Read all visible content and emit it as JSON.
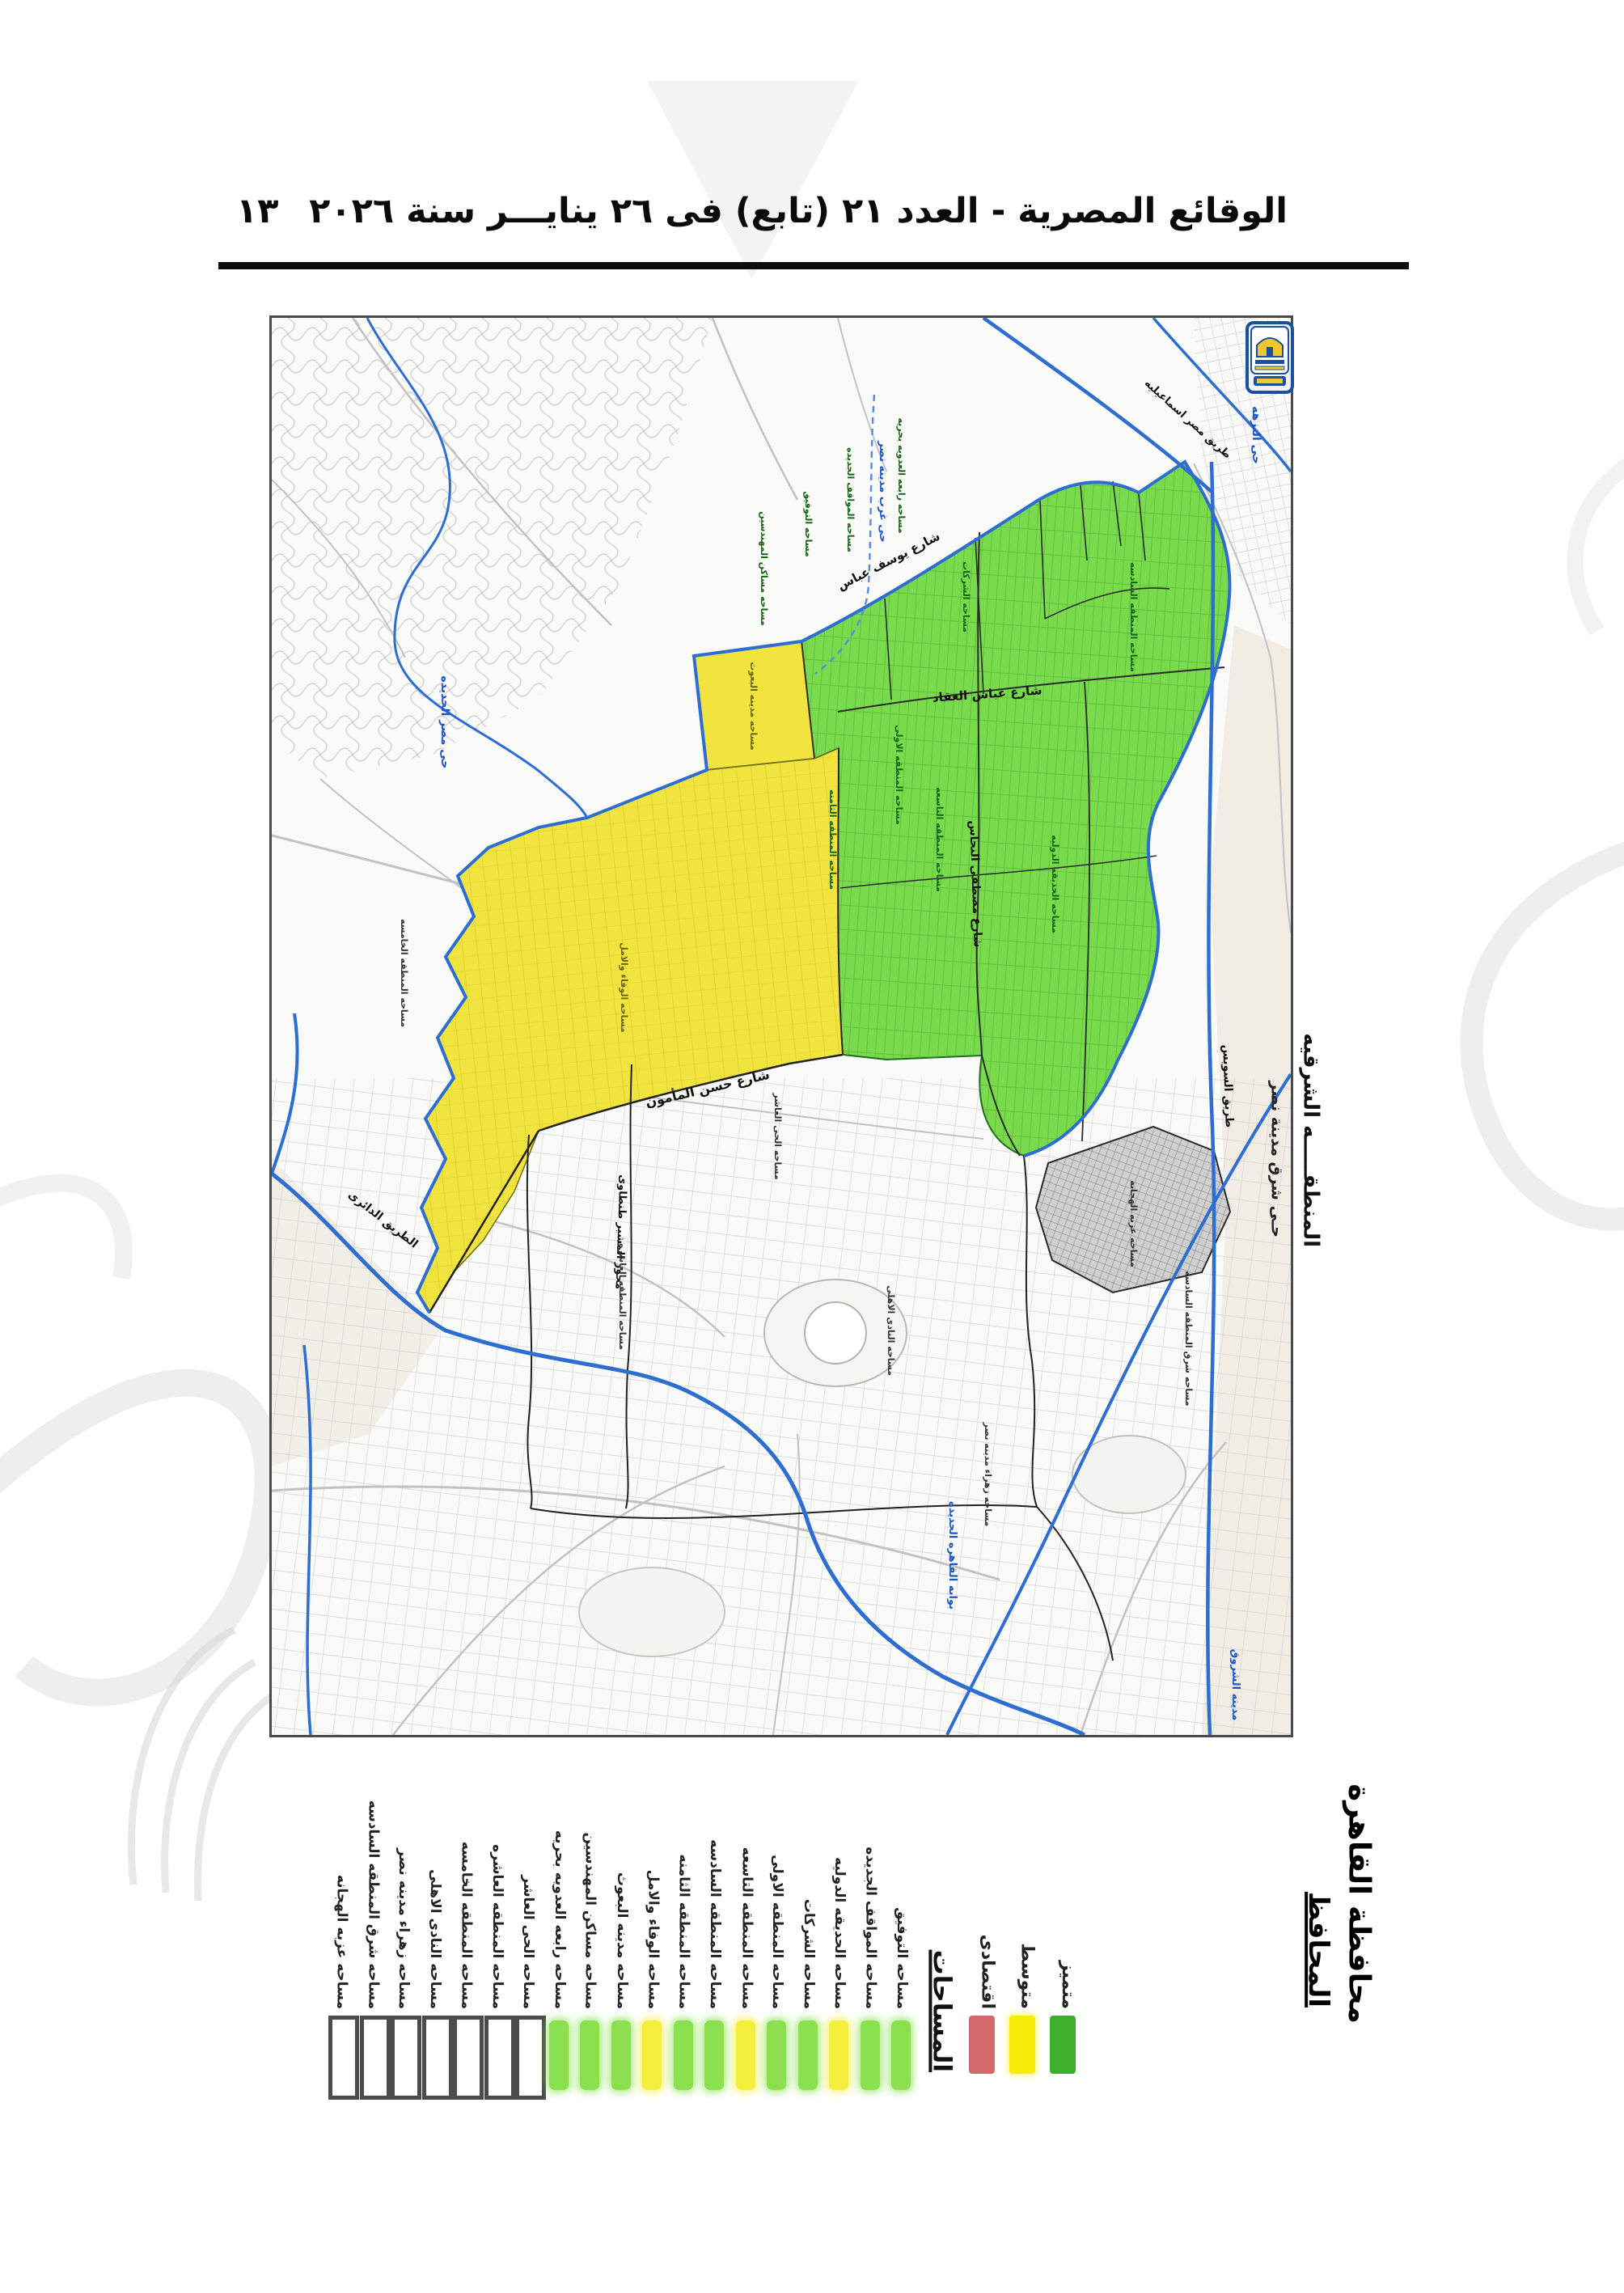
{
  "header": {
    "title": "الوقائع المصرية - العدد ٢١ (تابع) فى ٢٦ ينايـــر سنة ٢٠٢٦",
    "page_number": "١٣"
  },
  "map": {
    "region_title": "المنطقـــــه الشرقيه",
    "region_subtitle": "حـى شرق مدينة نصر",
    "streets": [
      "شارع يوسف عباس",
      "شارع عباس العقاد",
      "شارع مصطفى النحاس",
      "شارع حسن المأمون",
      "طريق السويس",
      "الطريق الدائرى",
      "محور المشير طنطاوى",
      "طريق مصر اسماعيليه"
    ],
    "district_labels": [
      "حى مصر الجديده",
      "حى النزهه",
      "حى غرب مدينه نصر",
      "بوابه القاهره الجديده",
      "مدينه الشروق"
    ],
    "green_area_labels": [
      "مساحه مساكن المهندسين",
      "مساحه التوفيق",
      "مساحه المواقف الجديده",
      "مساحه رابعه العدويه بحريه",
      "مساحه الشركات",
      "مساحه المنطقه السادسه",
      "مساحه المنطقه الاولى",
      "مساحه المنطقه الثامنه",
      "مساحه المنطقه التاسعه",
      "مساحه الحديقه الدوليه"
    ],
    "yellow_area_labels": [
      "مساحه الوفاء والامل",
      "مساحه مدينه البعوث"
    ],
    "gray_area_labels": [
      "مساحه الحى العاشر",
      "مساحه المنطقه العاشره",
      "مساحه المنطقه الخامسه",
      "مساحه عزبه الهجانه",
      "مساحه زهراء مدينه نصر",
      "مساحه النادى الاهلى",
      "مساحه شرق المنطقه السادسه"
    ]
  },
  "legend": {
    "heading": "المساحات",
    "categories": [
      {
        "label": "اقتصادى",
        "color": "#d4696c"
      },
      {
        "label": "متوسط",
        "color": "#f6ee08"
      },
      {
        "label": "متميز",
        "color": "#3fae2a"
      }
    ],
    "areas": [
      {
        "label": "مساحه عزبه الهجانه",
        "swatch": "outline"
      },
      {
        "label": "مساحه شرق المنطقه السادسه",
        "swatch": "outline"
      },
      {
        "label": "مساحه زهراء مدينه نصر",
        "swatch": "outline"
      },
      {
        "label": "مساحه النادى الاهلى",
        "swatch": "outline"
      },
      {
        "label": "مساحه المنطقه الخامسه",
        "swatch": "outline"
      },
      {
        "label": "مساحه المنطقه العاشره",
        "swatch": "outline"
      },
      {
        "label": "مساحه الحى العاشر",
        "swatch": "outline"
      },
      {
        "label": "مساحه رابعه العدويه بحريه",
        "swatch": "green"
      },
      {
        "label": "مساحه مساكن المهندسين",
        "swatch": "green"
      },
      {
        "label": "مساحه مدينه البعوث",
        "swatch": "green"
      },
      {
        "label": "مساحه الوفاء والامل",
        "swatch": "yellow"
      },
      {
        "label": "مساحه المنطقه الثامنه",
        "swatch": "green"
      },
      {
        "label": "مساحه المنطقه السادسه",
        "swatch": "green"
      },
      {
        "label": "مساحه المنطقه التاسعه",
        "swatch": "yellow"
      },
      {
        "label": "مساحه المنطقه الاولى",
        "swatch": "green"
      },
      {
        "label": "مساحه الشركات",
        "swatch": "green"
      },
      {
        "label": "مساحه الحديقه الدوليه",
        "swatch": "yellow"
      },
      {
        "label": "مساحه المواقف الجديده",
        "swatch": "green"
      },
      {
        "label": "مساحه التوفيق",
        "swatch": "green"
      }
    ]
  },
  "signature": {
    "org": "محافظة القاهرة",
    "title": "المحافظ"
  },
  "colors": {
    "zone_green": "#79da4c",
    "zone_yellow": "#f2e43e",
    "road_blue": "#2e6ed0",
    "label_blue": "#1d55c4",
    "label_green": "#156315",
    "frame": "#4a4a4a"
  }
}
